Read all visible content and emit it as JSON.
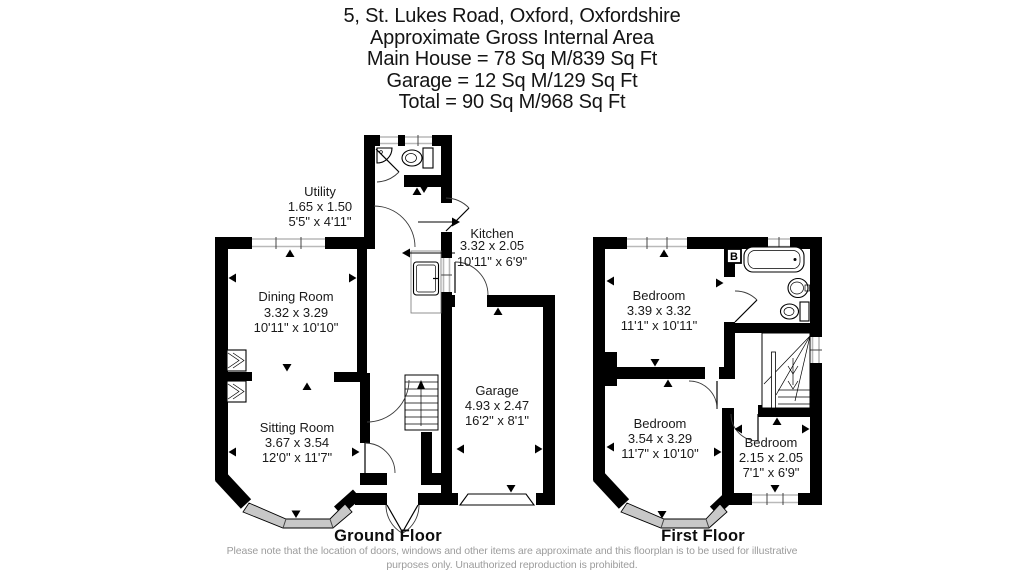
{
  "title": {
    "address": "5, St. Lukes Road, Oxford, Oxfordshire",
    "subtitle": "Approximate Gross Internal Area",
    "main_house": "Main House = 78 Sq M/839 Sq Ft",
    "garage": "Garage = 12 Sq M/129 Sq Ft",
    "total": "Total = 90 Sq M/968 Sq Ft"
  },
  "floors": {
    "ground": {
      "label": "Ground Floor",
      "rooms": {
        "utility": {
          "name": "Utility",
          "metric": "1.65 x 1.50",
          "imperial": "5'5\" x 4'11\""
        },
        "dining": {
          "name": "Dining Room",
          "metric": "3.32 x 3.29",
          "imperial": "10'11\" x 10'10\""
        },
        "sitting": {
          "name": "Sitting Room",
          "metric": "3.67 x 3.54",
          "imperial": "12'0\" x 11'7\""
        },
        "kitchen": {
          "name": "Kitchen",
          "metric": "3.32 x 2.05",
          "imperial": "10'11\" x 6'9\""
        },
        "garage": {
          "name": "Garage",
          "metric": "4.93 x 2.47",
          "imperial": "16'2\" x 8'1\""
        }
      }
    },
    "first": {
      "label": "First Floor",
      "boiler_label": "B",
      "rooms": {
        "bedroom1": {
          "name": "Bedroom",
          "metric": "3.39 x 3.32",
          "imperial": "11'1\" x 10'11\""
        },
        "bedroom2": {
          "name": "Bedroom",
          "metric": "3.54 x 3.29",
          "imperial": "11'7\" x 10'10\""
        },
        "bedroom3": {
          "name": "Bedroom",
          "metric": "2.15 x 2.05",
          "imperial": "7'1\" x 6'9\""
        }
      }
    }
  },
  "disclaimer": {
    "line1": "Please note that the location of doors, windows and other items are approximate and this floorplan is to be used for illustrative",
    "line2": "purposes only. Unauthorized reproduction is prohibited."
  },
  "colors": {
    "wall": "#000000",
    "glass": "#c8c8c8",
    "text": "#1a1a1a",
    "muted": "#9c9c9c"
  }
}
